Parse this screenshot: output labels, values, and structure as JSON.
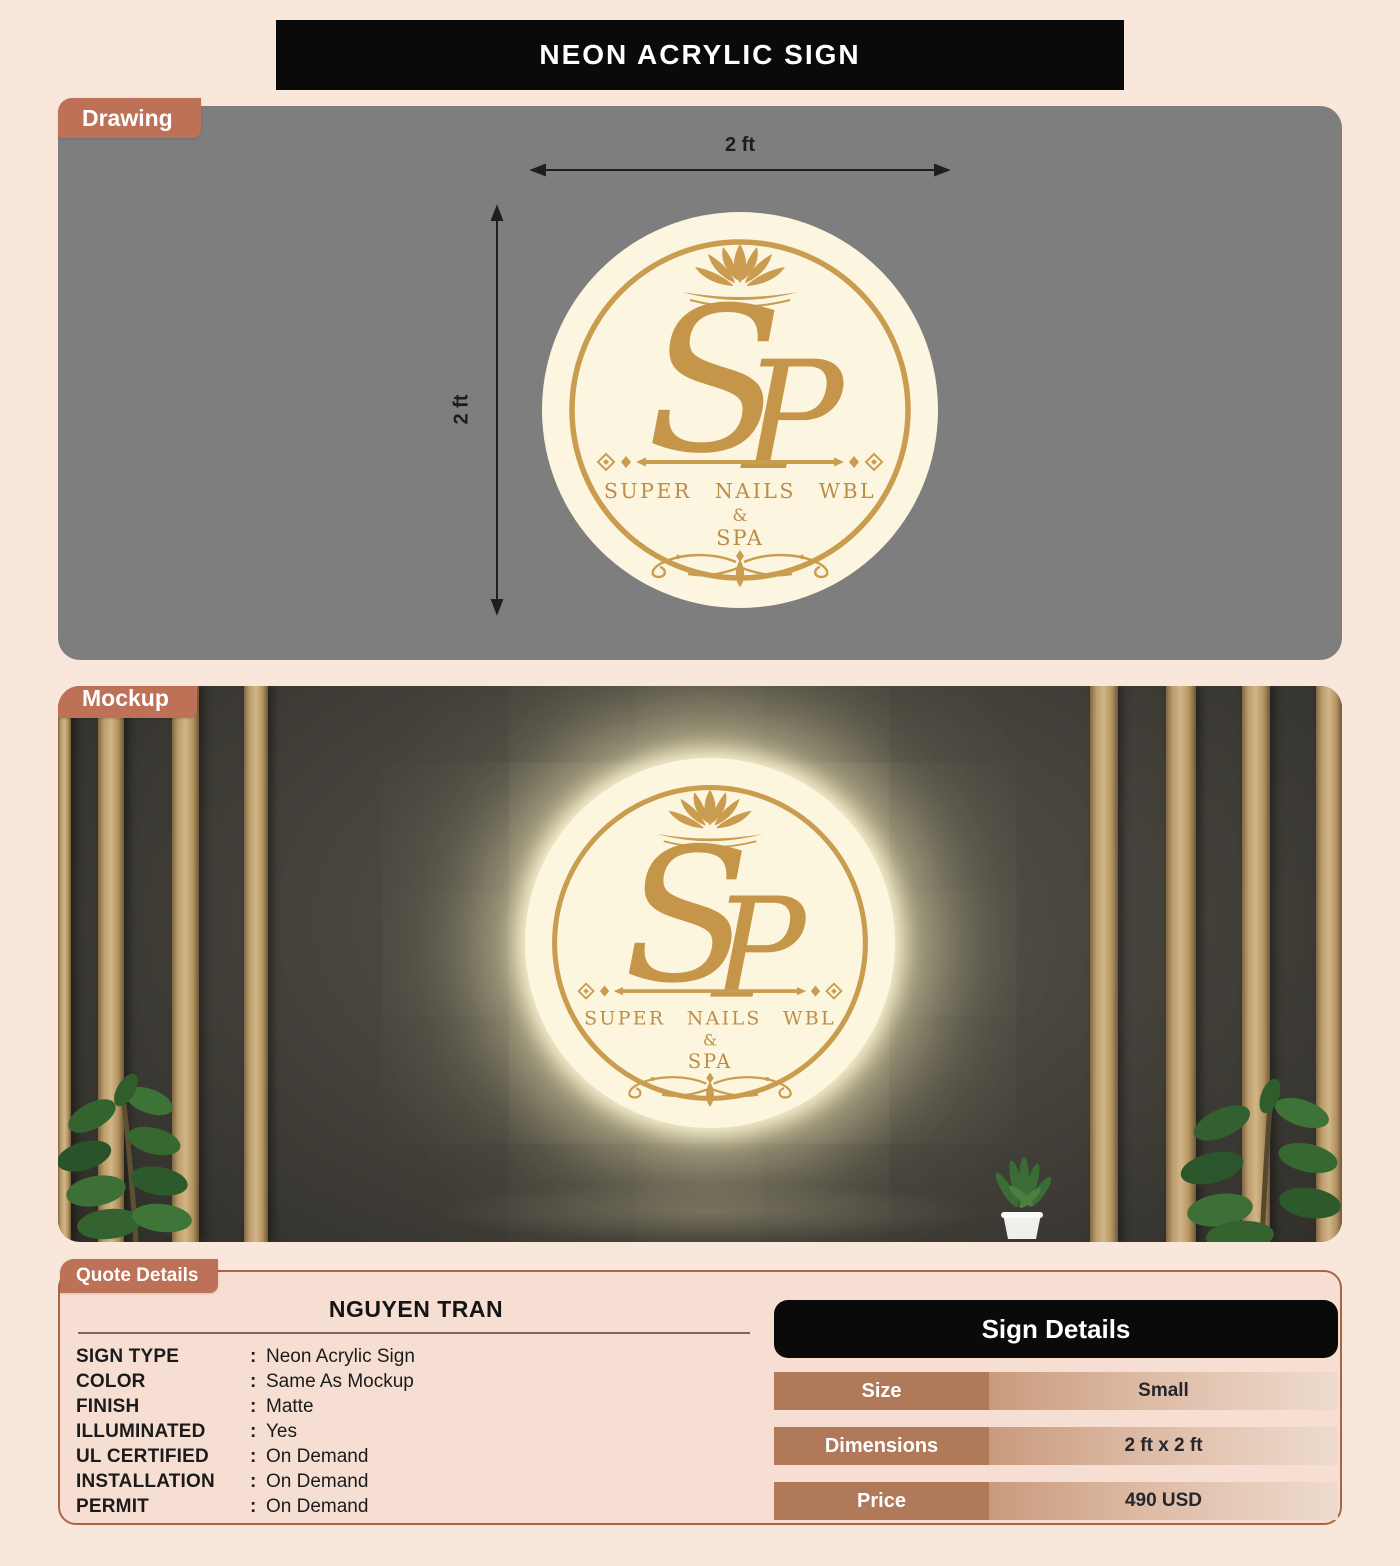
{
  "title": "NEON ACRYLIC SIGN",
  "drawing": {
    "label": "Drawing",
    "width_label": "2 ft",
    "height_label": "2 ft"
  },
  "mockup": {
    "label": "Mockup"
  },
  "logo": {
    "monogram_s": "S",
    "monogram_p": "P",
    "line1": "SUPER NAILS WBL",
    "amp": "&",
    "line2": "SPA"
  },
  "quote": {
    "label": "Quote Details",
    "customer_name": "NGUYEN TRAN",
    "colon": ":",
    "fields": [
      {
        "label": "SIGN TYPE",
        "value": "Neon Acrylic Sign"
      },
      {
        "label": "COLOR",
        "value": "Same As Mockup"
      },
      {
        "label": "FINISH",
        "value": "Matte"
      },
      {
        "label": "ILLUMINATED",
        "value": "Yes"
      },
      {
        "label": "UL CERTIFIED",
        "value": "On Demand"
      },
      {
        "label": "INSTALLATION",
        "value": "On Demand"
      },
      {
        "label": "PERMIT",
        "value": "On Demand"
      }
    ],
    "sign_details": {
      "title": "Sign Details",
      "rows": [
        {
          "label": "Size",
          "value": "Small"
        },
        {
          "label": "Dimensions",
          "value": "2 ft x 2 ft"
        },
        {
          "label": "Price",
          "value": "490 USD"
        }
      ]
    }
  },
  "colors": {
    "page_background": "#f9e7db",
    "banner_black": "#0a0a0a",
    "tab_terracotta": "#bd7156",
    "drawing_gray": "#7e7e7e",
    "logo_cream": "#fcf5e0",
    "logo_gold": "#c99c4f",
    "quote_panel": "#f6dfd2",
    "quote_border": "#aa6644",
    "table_label_cell": "#b0795a",
    "value_gradient_start": "#c99a7d",
    "value_gradient_end": "#eedbcd"
  }
}
